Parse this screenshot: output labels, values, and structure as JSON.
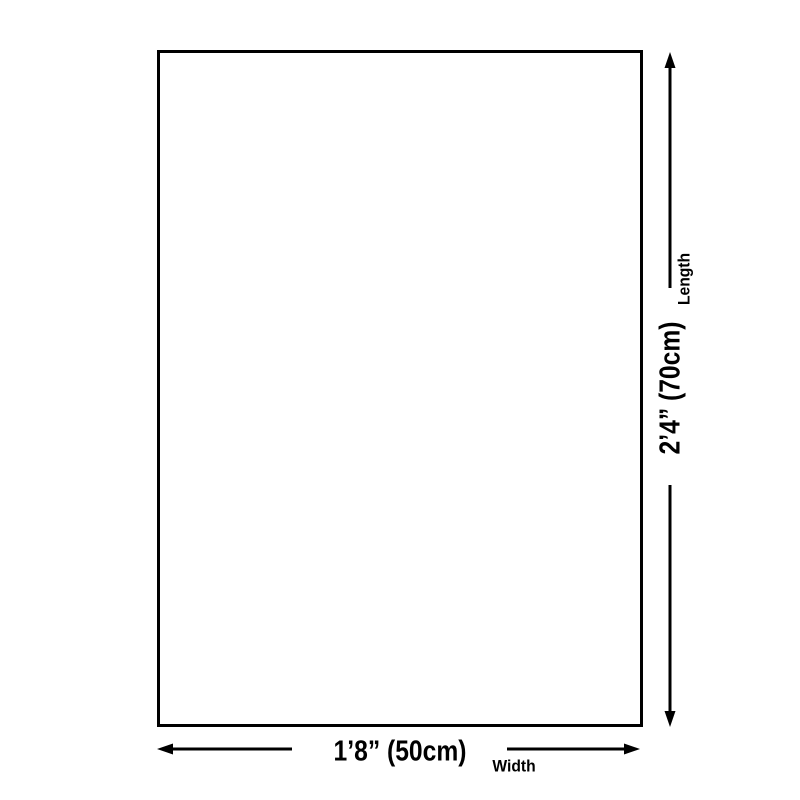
{
  "diagram": {
    "name": "product-size-diagram",
    "background_color": "#ffffff",
    "line_color": "#000000"
  },
  "dimensions": {
    "length": {
      "value": "2’4” (70cm)",
      "label": "Length"
    },
    "width": {
      "value": "1’8” (50cm)",
      "label": "Width"
    }
  },
  "icons": {
    "arrow_up": "arrow-up-icon",
    "arrow_down": "arrow-down-icon",
    "arrow_left": "arrow-left-icon",
    "arrow_right": "arrow-right-icon"
  }
}
